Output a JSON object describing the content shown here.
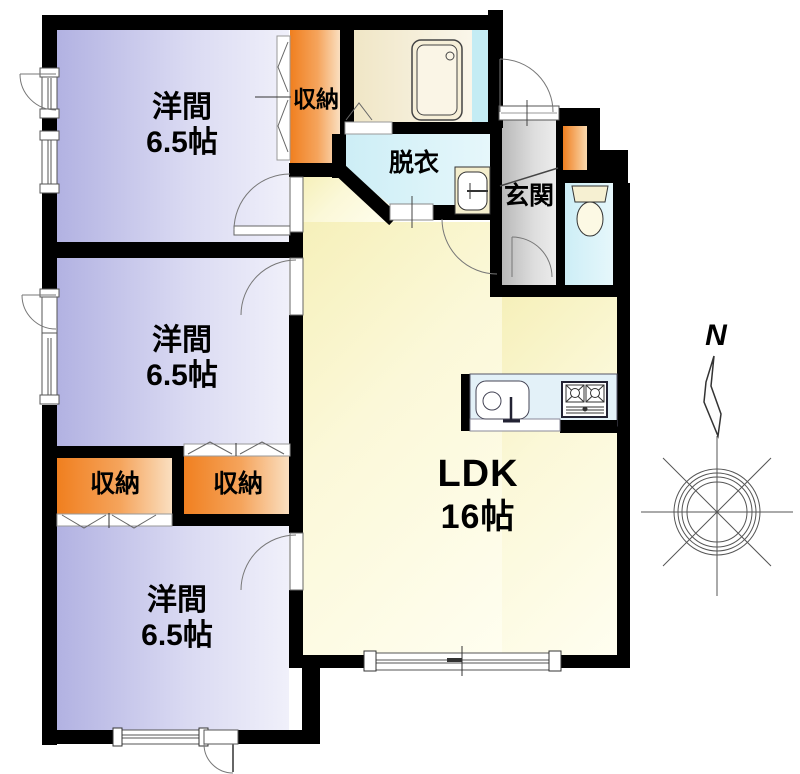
{
  "rooms": {
    "room1": {
      "name": "洋間",
      "area": "6.5帖"
    },
    "room2": {
      "name": "洋間",
      "area": "6.5帖"
    },
    "room3": {
      "name": "洋間",
      "area": "6.5帖"
    },
    "ldk": {
      "name": "LDK",
      "area": "16帖"
    },
    "dressing": {
      "name": "脱衣"
    },
    "entrance": {
      "name": "玄関"
    }
  },
  "closets": {
    "top": {
      "name": "収納"
    },
    "left": {
      "name": "収納"
    },
    "right": {
      "name": "収納"
    }
  },
  "compass": {
    "north": "N"
  },
  "colors": {
    "wall": "#000000",
    "western_room": "#c3c3ea",
    "ldk": "#faf6d2",
    "closet_orange": "#f08522",
    "wet_area": "#d4eff6",
    "entrance_gray": "#cccccc",
    "bathroom": "#f2e9cf"
  }
}
